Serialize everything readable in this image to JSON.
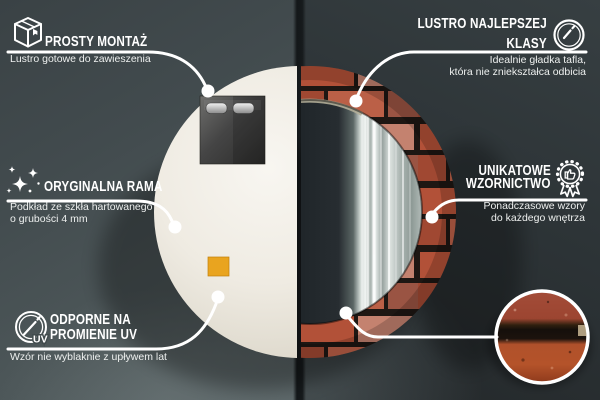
{
  "page": {
    "kind": "product-infographic",
    "language": "pl"
  },
  "colors": {
    "bg_left_panel": "#47514f",
    "bg_right_panel": "#2c3234",
    "divider": "#15191b",
    "line_white": "#ffffff",
    "mirror_back": "#efebe2",
    "brick_red": "#b25138",
    "mortar_dark": "#1e1713",
    "sticker_orange": "#e9a41f",
    "detail_brick": "#ad4f2c"
  },
  "callouts": {
    "top_left": {
      "icon": "package-box-icon",
      "title": "PROSTY MONTAŻ",
      "subtitle": "Lustro gotowe do zawieszenia"
    },
    "top_right": {
      "icon": "round-mirror-icon",
      "title_lines": [
        "LUSTRO NAJLEPSZEJ",
        "KLASY"
      ],
      "subtitle_lines": [
        "Idealnie gładka tafla,",
        "która nie zniekształca odbicia"
      ]
    },
    "mid_left": {
      "icon": "sparkles-icon",
      "title": "ORYGINALNA RAMA",
      "subtitle_lines": [
        "Podkład ze szkła hartowanego",
        "o grubości 4 mm"
      ]
    },
    "mid_right": {
      "icon": "award-badge-icon",
      "title_lines": [
        "UNIKATOWE",
        "WZORNICTWO"
      ],
      "subtitle_lines": [
        "Ponadczasowe wzory",
        "do każdego wnętrza"
      ]
    },
    "bottom_left": {
      "icon": "uv-protection-icon",
      "icon_text": "UV",
      "title_lines": [
        "ODPORNE NA",
        "PROMIENIE UV"
      ],
      "subtitle": "Wzór nie wyblaknie z upływem lat"
    }
  }
}
